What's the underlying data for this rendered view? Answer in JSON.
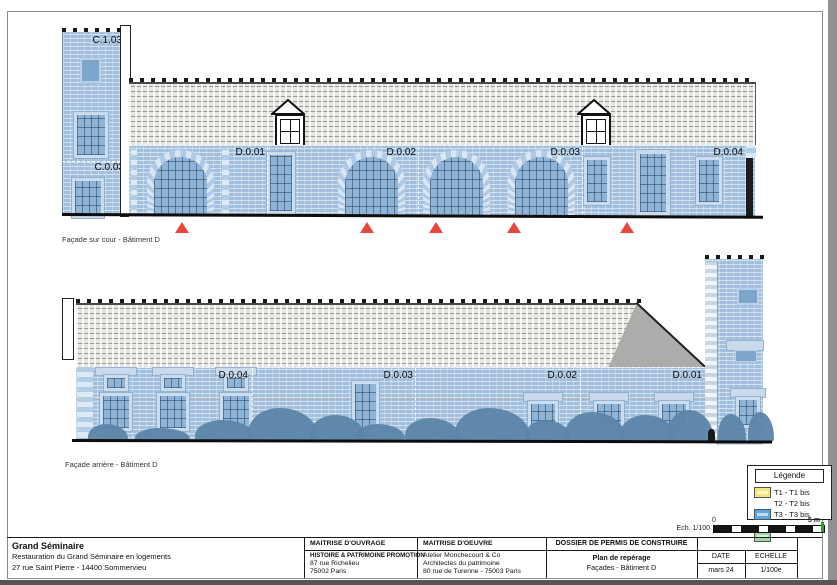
{
  "colors": {
    "highlight_blue": "#a2c0de",
    "marker_red": "#e8473e",
    "roof_gray": "#e7e6e3",
    "vegetation_blue": "#5d85a9"
  },
  "captions": {
    "facade_top": "Façade sur cour - Bâtiment D",
    "facade_bottom": "Façade arrière - Bâtiment D"
  },
  "facade_top": {
    "tower_upper": "C.1.03",
    "tower_lower": "C.0.03",
    "sections": [
      "D.0.01",
      "D.0.02",
      "D.0.03",
      "D.0.04"
    ]
  },
  "facade_bottom": {
    "sections": [
      "D.0.04",
      "D.0.03",
      "D.0.02",
      "D.0.01"
    ]
  },
  "legend": {
    "title": "Légende",
    "items": [
      {
        "label": "T1 - T1 bis",
        "color": "#efe87c"
      },
      {
        "label": "T2 - T2 bis",
        "color": "#5ea6dc"
      },
      {
        "label": "T3 - T3 bis",
        "color": "#a4d7a6"
      }
    ]
  },
  "scale": {
    "note": "Ech. 1/100",
    "start": "0",
    "end": "5 m"
  },
  "titleblock": {
    "project": {
      "name": "Grand Séminaire",
      "line2": "Restauration du Grand Séminaire en logements",
      "line3": "27 rue Saint Pierre - 14400 Sommervieu"
    },
    "moa": {
      "header": "MAITRISE D'OUVRAGE",
      "name": "HISTOIRE & PATRIMOINE PROMOTION",
      "line2": "87 rue Richelieu",
      "line3": "75002 Paris"
    },
    "moe": {
      "header": "MAITRISE D'OEUVRE",
      "name": "Atelier Monchecourt & Co",
      "line2": "Architectes du patrimoine",
      "line3": "80 rue de Turenne - 75003 Paris"
    },
    "dossier": {
      "header": "DOSSIER DE PERMIS DE CONSTRUIRE",
      "title": "Plan de repérage",
      "subtitle": "Façades - Bâtiment D"
    },
    "date": {
      "header": "DATE",
      "value": "mars 24"
    },
    "echelle": {
      "header": "ECHELLE",
      "value": "1/100e"
    }
  }
}
